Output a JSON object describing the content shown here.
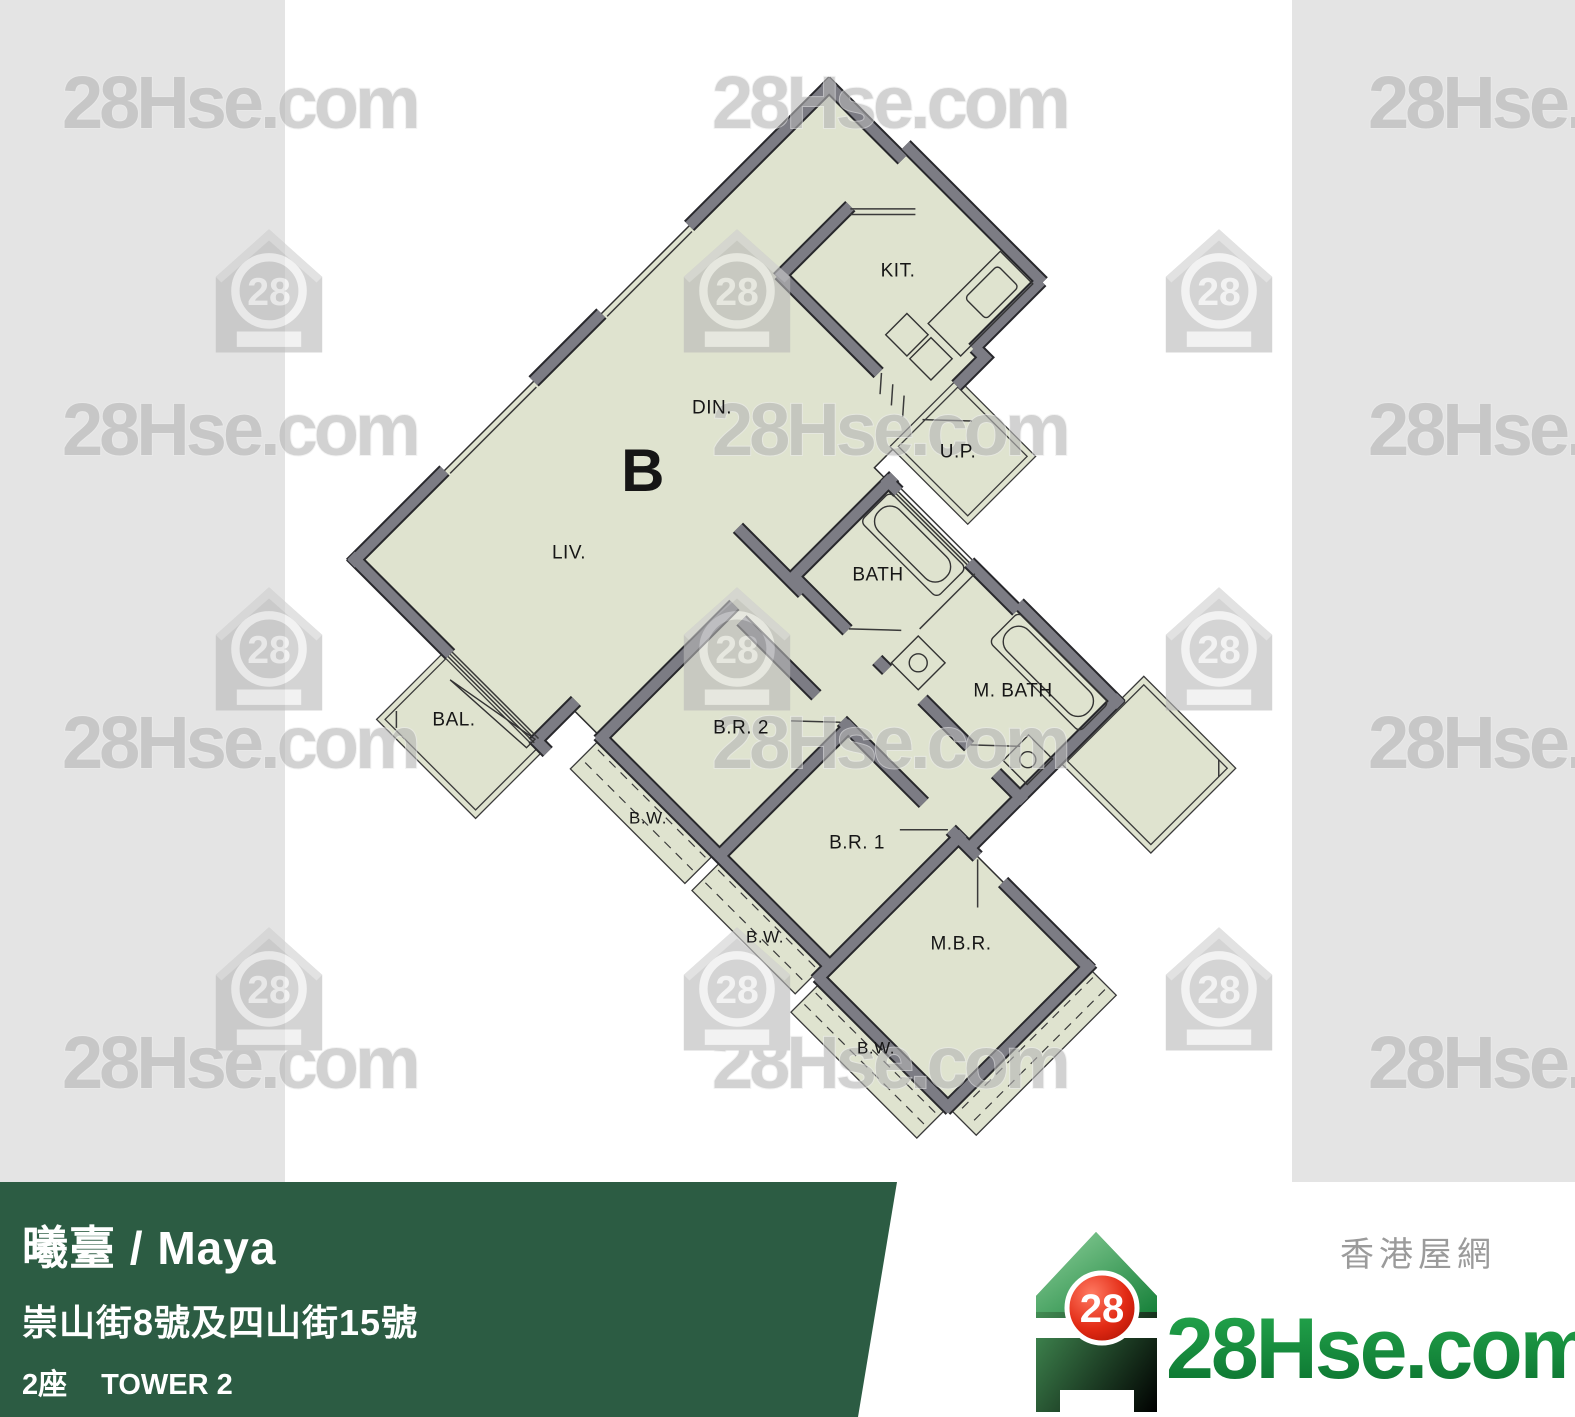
{
  "brand": {
    "site": "28Hse.com",
    "site_zh": "香港屋網",
    "logo_number": "28",
    "green_footer": "#2c5c43",
    "brand_green": "#13913c",
    "logo_red": "#d92613"
  },
  "watermarks": {
    "text": "28Hse.com",
    "text_positions": [
      {
        "x": 62,
        "y": 128
      },
      {
        "x": 712,
        "y": 128
      },
      {
        "x": 1368,
        "y": 128
      },
      {
        "x": 62,
        "y": 455
      },
      {
        "x": 712,
        "y": 455
      },
      {
        "x": 1368,
        "y": 455
      },
      {
        "x": 62,
        "y": 768
      },
      {
        "x": 712,
        "y": 768
      },
      {
        "x": 1368,
        "y": 768
      },
      {
        "x": 62,
        "y": 1088
      },
      {
        "x": 712,
        "y": 1088
      },
      {
        "x": 1368,
        "y": 1088
      }
    ],
    "logo_positions": [
      {
        "x": 213,
        "y": 225
      },
      {
        "x": 681,
        "y": 225
      },
      {
        "x": 1163,
        "y": 225
      },
      {
        "x": 213,
        "y": 583
      },
      {
        "x": 681,
        "y": 583
      },
      {
        "x": 1163,
        "y": 583
      },
      {
        "x": 213,
        "y": 923
      },
      {
        "x": 681,
        "y": 923
      },
      {
        "x": 1163,
        "y": 923
      }
    ]
  },
  "floor_plan": {
    "unit": "B",
    "fill_color": "#dfe3cf",
    "wall_color": "#7c7c84",
    "labels": [
      {
        "text": "B",
        "x": 643,
        "y": 471,
        "size": 60,
        "weight": 600
      },
      {
        "text": "KIT.",
        "x": 898,
        "y": 271,
        "size": 19,
        "weight": 400
      },
      {
        "text": "DIN.",
        "x": 712,
        "y": 408,
        "size": 19,
        "weight": 400
      },
      {
        "text": "U.P.",
        "x": 958,
        "y": 452,
        "size": 19,
        "weight": 400
      },
      {
        "text": "LIV.",
        "x": 569,
        "y": 553,
        "size": 19,
        "weight": 400
      },
      {
        "text": "BATH",
        "x": 878,
        "y": 575,
        "size": 19,
        "weight": 400
      },
      {
        "text": "M. BATH",
        "x": 1013,
        "y": 691,
        "size": 19,
        "weight": 400
      },
      {
        "text": "BAL.",
        "x": 454,
        "y": 720,
        "size": 19,
        "weight": 400
      },
      {
        "text": "B.R. 2",
        "x": 741,
        "y": 728,
        "size": 19,
        "weight": 400
      },
      {
        "text": "B.W.",
        "x": 648,
        "y": 818,
        "size": 17,
        "weight": 400
      },
      {
        "text": "B.R. 1",
        "x": 857,
        "y": 843,
        "size": 19,
        "weight": 400
      },
      {
        "text": "B.W.",
        "x": 765,
        "y": 937,
        "size": 17,
        "weight": 400
      },
      {
        "text": "M.B.R.",
        "x": 961,
        "y": 944,
        "size": 19,
        "weight": 400
      },
      {
        "text": "B.W.",
        "x": 876,
        "y": 1048,
        "size": 17,
        "weight": 400
      }
    ]
  },
  "footer": {
    "title": "曦臺 / Maya",
    "address": "崇山街8號及四山街15號",
    "tower_zh": "2座",
    "tower_en": "TOWER 2",
    "area": "716 sqf(實用面積 Saleable Area)"
  }
}
